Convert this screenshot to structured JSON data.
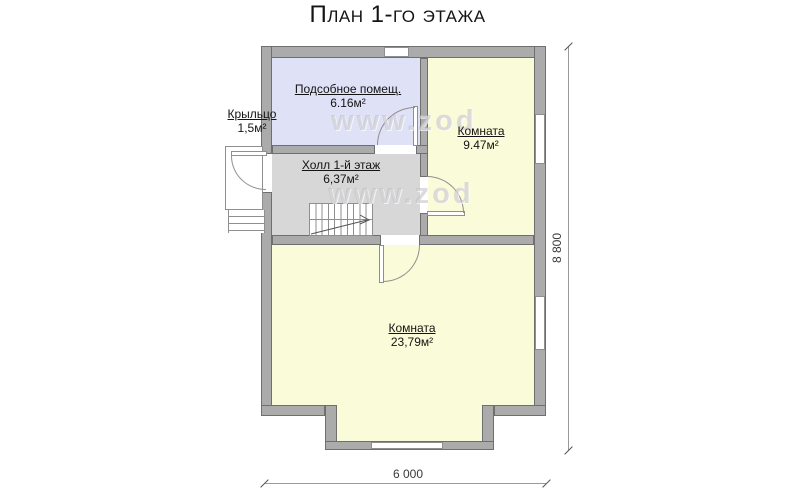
{
  "title": "План 1-го этажа",
  "watermark": {
    "text": "www.zod"
  },
  "rooms": {
    "utility": {
      "name": "Подсобное помещ.",
      "area": "6.16м²"
    },
    "room_small": {
      "name": "Комната",
      "area": "9.47м²"
    },
    "hall": {
      "name": "Холл 1-й этаж",
      "area": "6,37м²"
    },
    "room_big": {
      "name": "Комната",
      "area": "23,79м²"
    },
    "porch": {
      "name": "Крыльцо",
      "area": "1,5м²"
    }
  },
  "dimensions": {
    "overall_depth": "8 800",
    "overall_width": "6 000"
  },
  "colors": {
    "wall-fill": "#ababab",
    "wall-edge": "#6f6f6f",
    "floor-room": "#fafbd9",
    "floor-utility": "#dfe1f6",
    "floor-hall": "#d7d7d7",
    "thin-line": "#8f8f8f",
    "dim-line": "#9a9a9a",
    "text": "#141414"
  }
}
